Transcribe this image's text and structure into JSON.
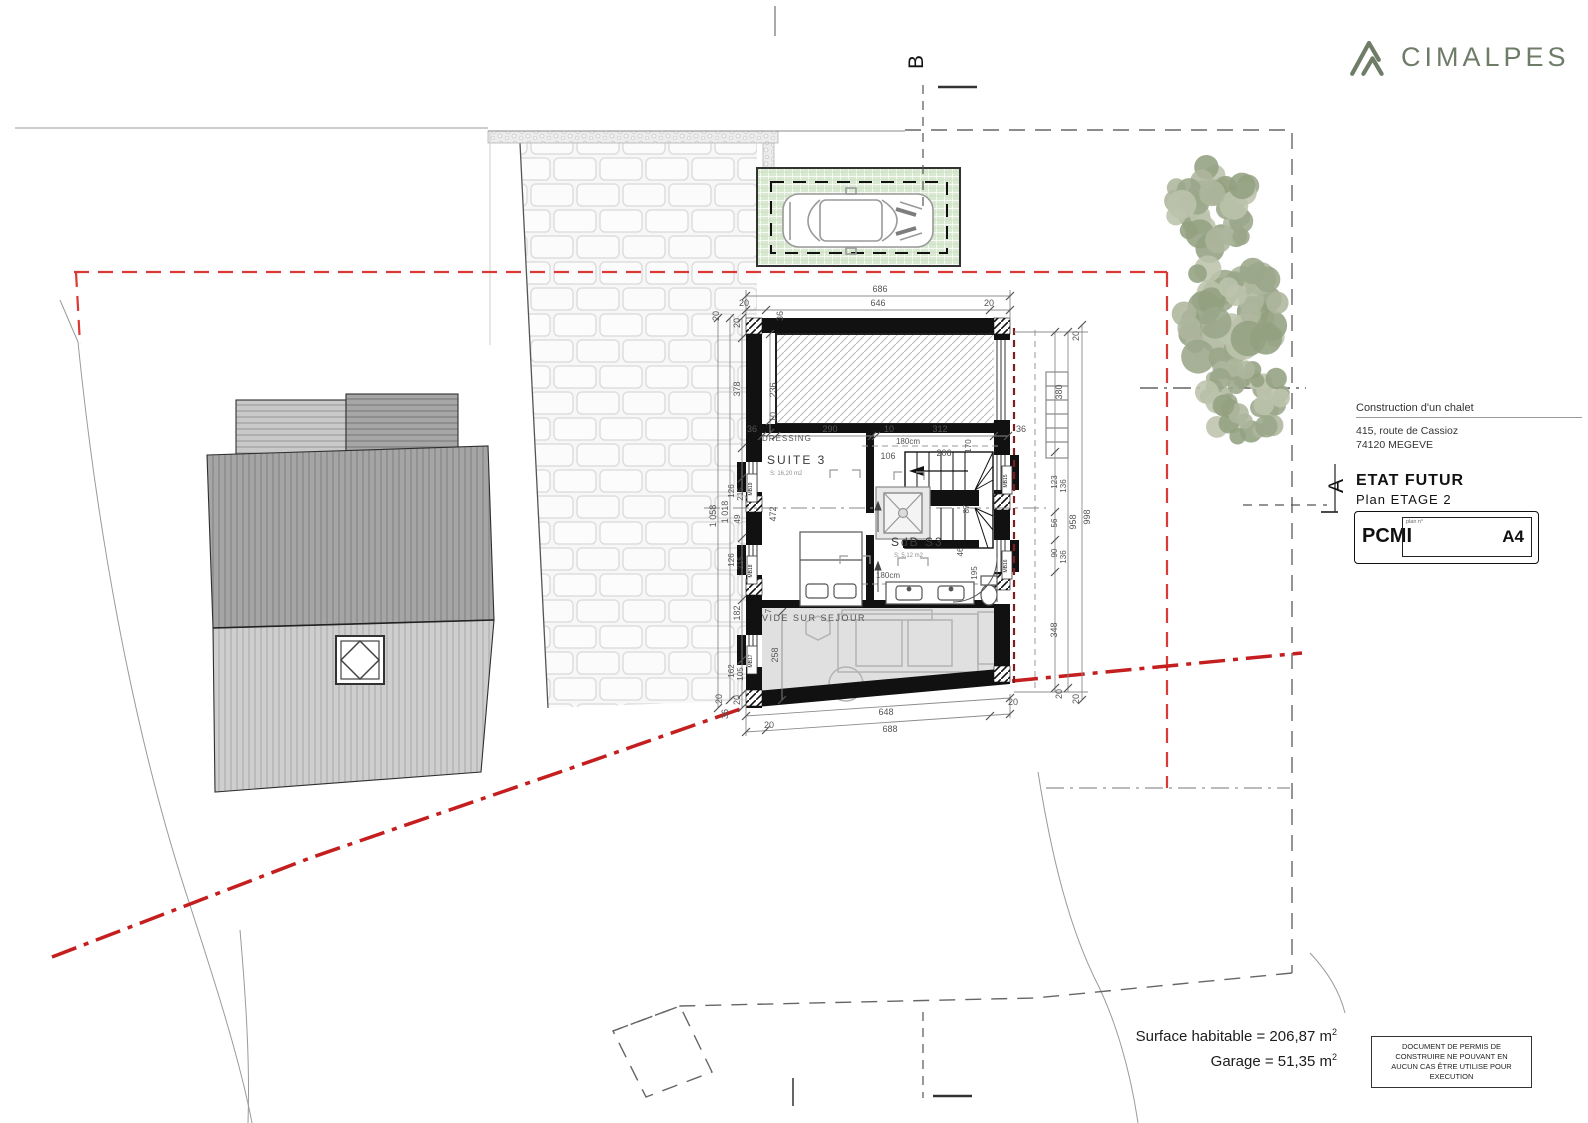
{
  "branding": {
    "logo_text": "CIMALPES"
  },
  "title_block": {
    "project": "Construction d'un chalet",
    "address_line1": "415, route de Cassioz",
    "address_line2": "74120 MEGEVE",
    "state_label": "ETAT FUTUR",
    "plan_label": "Plan ETAGE 2",
    "doc_code": "PCMI",
    "plan_no_label": "plan n°",
    "sheet": "A4"
  },
  "section_markers": {
    "a": "A",
    "b": "B"
  },
  "areas": [
    {
      "text": "Surface habitable = 206,87 m",
      "sup": "2"
    },
    {
      "text": "Garage = 51,35 m",
      "sup": "2"
    }
  ],
  "disclaimer": {
    "lines": [
      "DOCUMENT DE PERMIS DE",
      "CONSTRUIRE NE POUVANT EN",
      "AUCUN CAS ÊTRE UTILISE POUR",
      "EXECUTION"
    ]
  },
  "plan": {
    "trees": [
      {
        "cx": 1212,
        "cy": 207,
        "r": 54
      },
      {
        "cx": 1232,
        "cy": 312,
        "r": 66
      },
      {
        "cx": 1243,
        "cy": 398,
        "r": 47
      }
    ],
    "labels": [
      {
        "t": "DRESSING",
        "x": 762,
        "y": 441,
        "s": 8,
        "a": "start",
        "ls": 1
      },
      {
        "t": "SUITE 3",
        "x": 767,
        "y": 464,
        "s": 12,
        "a": "start",
        "ls": 2,
        "c": "rm"
      },
      {
        "t": "S: 16,20 m2",
        "x": 770,
        "y": 475,
        "s": 6,
        "a": "start",
        "c": "fa"
      },
      {
        "t": "SdB S3",
        "x": 891,
        "y": 546,
        "s": 12,
        "a": "start",
        "ls": 2,
        "c": "rm"
      },
      {
        "t": "S: 5,12 m2",
        "x": 894,
        "y": 557,
        "s": 6,
        "a": "start",
        "c": "fa"
      },
      {
        "t": "VIDE SUR SEJOUR",
        "x": 762,
        "y": 621,
        "s": 9,
        "a": "start",
        "ls": 1.5
      },
      {
        "t": "180cm",
        "x": 908,
        "y": 444,
        "s": 8
      },
      {
        "t": "180cm",
        "x": 888,
        "y": 578,
        "s": 8
      },
      {
        "t": "686",
        "x": 880,
        "y": 292,
        "s": 9
      },
      {
        "t": "20",
        "x": 744,
        "y": 306,
        "s": 9
      },
      {
        "t": "646",
        "x": 878,
        "y": 306,
        "s": 9
      },
      {
        "t": "20",
        "x": 989,
        "y": 306,
        "s": 9
      },
      {
        "t": "36",
        "x": 783,
        "y": 316,
        "s": 9,
        "r": -90
      },
      {
        "t": "20",
        "x": 719,
        "y": 316,
        "s": 9,
        "r": -90
      },
      {
        "t": "36",
        "x": 752,
        "y": 432,
        "s": 9
      },
      {
        "t": "290",
        "x": 830,
        "y": 432,
        "s": 9
      },
      {
        "t": "10",
        "x": 889,
        "y": 432,
        "s": 9
      },
      {
        "t": "312",
        "x": 940,
        "y": 432,
        "s": 9
      },
      {
        "t": "36",
        "x": 1021,
        "y": 432,
        "s": 9
      },
      {
        "t": "236",
        "x": 776,
        "y": 390,
        "s": 9,
        "r": -90
      },
      {
        "t": "10",
        "x": 776,
        "y": 417,
        "s": 9,
        "r": -90
      },
      {
        "t": "106",
        "x": 888,
        "y": 459,
        "s": 9
      },
      {
        "t": "206",
        "x": 944,
        "y": 456,
        "s": 9
      },
      {
        "t": "170",
        "x": 971,
        "y": 446,
        "s": 8,
        "r": -90
      },
      {
        "t": "87",
        "x": 969,
        "y": 509,
        "s": 8,
        "r": -90
      },
      {
        "t": "46",
        "x": 963,
        "y": 552,
        "s": 8,
        "r": -90
      },
      {
        "t": "195",
        "x": 977,
        "y": 573,
        "s": 8,
        "r": -90
      },
      {
        "t": "472",
        "x": 776,
        "y": 514,
        "s": 9,
        "r": -90
      },
      {
        "t": "7",
        "x": 771,
        "y": 611,
        "s": 8,
        "r": -90
      },
      {
        "t": "258",
        "x": 778,
        "y": 655,
        "s": 9,
        "r": -90
      },
      {
        "t": "1 058",
        "x": 716,
        "y": 516,
        "s": 9,
        "r": -90
      },
      {
        "t": "1 018",
        "x": 728,
        "y": 512,
        "s": 9,
        "r": -90
      },
      {
        "t": "20",
        "x": 740,
        "y": 323,
        "s": 9,
        "r": -90
      },
      {
        "t": "378",
        "x": 740,
        "y": 389,
        "s": 9,
        "r": -90
      },
      {
        "t": "126",
        "x": 734,
        "y": 491,
        "s": 8,
        "r": -90
      },
      {
        "t": "215",
        "x": 743,
        "y": 494,
        "s": 8,
        "r": -90
      },
      {
        "t": "49",
        "x": 740,
        "y": 519,
        "s": 8,
        "r": -90
      },
      {
        "t": "126",
        "x": 734,
        "y": 560,
        "s": 8,
        "r": -90
      },
      {
        "t": "215",
        "x": 743,
        "y": 563,
        "s": 8,
        "r": -90
      },
      {
        "t": "182",
        "x": 740,
        "y": 613,
        "s": 9,
        "r": -90
      },
      {
        "t": "162",
        "x": 734,
        "y": 671,
        "s": 8,
        "r": -90
      },
      {
        "t": "105",
        "x": 743,
        "y": 674,
        "s": 8,
        "r": -90
      },
      {
        "t": "20",
        "x": 740,
        "y": 700,
        "s": 9,
        "r": -90
      },
      {
        "t": "20",
        "x": 722,
        "y": 699,
        "s": 9,
        "r": -90
      },
      {
        "t": "36",
        "x": 728,
        "y": 714,
        "s": 9,
        "r": -90
      },
      {
        "t": "20",
        "x": 1079,
        "y": 336,
        "s": 9,
        "r": -90
      },
      {
        "t": "380",
        "x": 1062,
        "y": 392,
        "s": 9,
        "r": -90
      },
      {
        "t": "123",
        "x": 1057,
        "y": 482,
        "s": 8,
        "r": -90
      },
      {
        "t": "136",
        "x": 1066,
        "y": 486,
        "s": 8,
        "r": -90
      },
      {
        "t": "56",
        "x": 1057,
        "y": 523,
        "s": 8,
        "r": -90
      },
      {
        "t": "958",
        "x": 1076,
        "y": 522,
        "s": 9,
        "r": -90
      },
      {
        "t": "998",
        "x": 1090,
        "y": 517,
        "s": 9,
        "r": -90
      },
      {
        "t": "90",
        "x": 1057,
        "y": 553,
        "s": 8,
        "r": -90
      },
      {
        "t": "136",
        "x": 1066,
        "y": 557,
        "s": 8,
        "r": -90
      },
      {
        "t": "348",
        "x": 1057,
        "y": 630,
        "s": 9,
        "r": -90
      },
      {
        "t": "20",
        "x": 1062,
        "y": 694,
        "s": 9,
        "r": -90
      },
      {
        "t": "20",
        "x": 1079,
        "y": 699,
        "s": 9,
        "r": -90
      },
      {
        "t": "648",
        "x": 886,
        "y": 715,
        "s": 9
      },
      {
        "t": "688",
        "x": 890,
        "y": 732,
        "s": 9
      },
      {
        "t": "20",
        "x": 769,
        "y": 728,
        "s": 9
      },
      {
        "t": "20",
        "x": 1013,
        "y": 705,
        "s": 9
      },
      {
        "t": "MB19",
        "x": 752,
        "y": 489,
        "s": 5,
        "r": -90,
        "c": "wt"
      },
      {
        "t": "MB18",
        "x": 752,
        "y": 571,
        "s": 5,
        "r": -90,
        "c": "wt"
      },
      {
        "t": "MB17",
        "x": 752,
        "y": 661,
        "s": 5,
        "r": -90,
        "c": "wt"
      },
      {
        "t": "MB15",
        "x": 1007,
        "y": 481,
        "s": 5,
        "r": -90,
        "c": "wt"
      },
      {
        "t": "MB16",
        "x": 1007,
        "y": 566,
        "s": 5,
        "r": -90,
        "c": "wt"
      }
    ]
  },
  "colors": {
    "brand_green": "#6e7c68",
    "limit_red": "#d93a36",
    "limit_red_thick": "#c41e1e",
    "roofline_darkred": "#7d1d1d",
    "parking_green": "#d9e8d0"
  }
}
